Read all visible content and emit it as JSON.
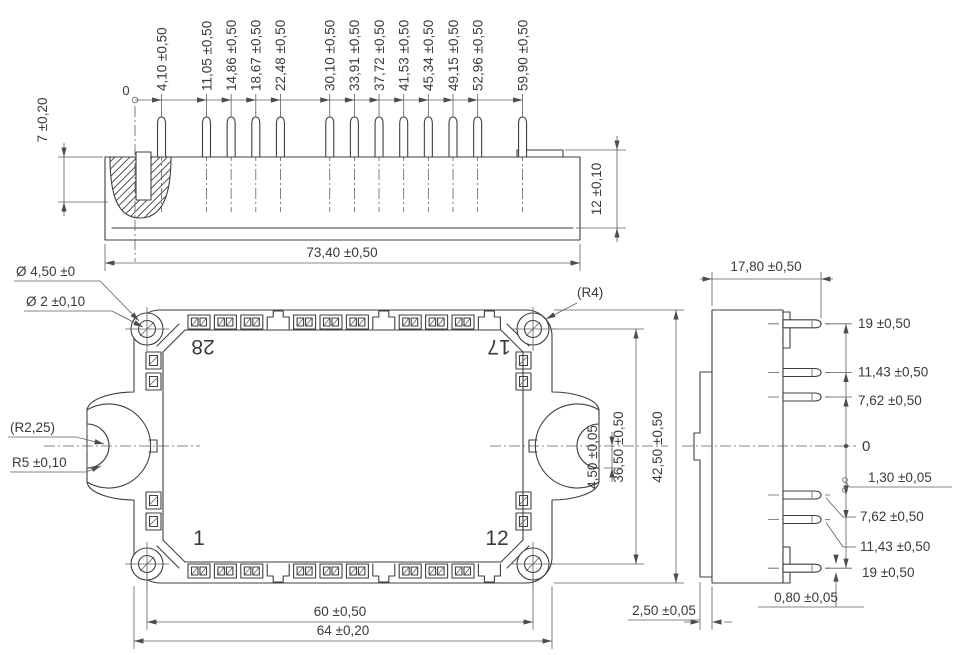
{
  "drawing_title": "power-module-outline-drawing",
  "front_view": {
    "origin_label": "0",
    "pins": [
      {
        "mm": 4.1,
        "label": "4,10 ±0,50"
      },
      {
        "mm": 11.05,
        "label": "11,05 ±0,50"
      },
      {
        "mm": 14.86,
        "label": "14,86 ±0,50"
      },
      {
        "mm": 18.67,
        "label": "18,67 ±0,50"
      },
      {
        "mm": 22.48,
        "label": "22,48 ±0,50"
      },
      {
        "mm": 30.1,
        "label": "30,10 ±0,50"
      },
      {
        "mm": 33.91,
        "label": "33,91 ±0,50"
      },
      {
        "mm": 37.72,
        "label": "37,72 ±0,50"
      },
      {
        "mm": 41.53,
        "label": "41,53 ±0,50"
      },
      {
        "mm": 45.34,
        "label": "45,34 ±0,50"
      },
      {
        "mm": 49.15,
        "label": "49,15 ±0,50"
      },
      {
        "mm": 52.96,
        "label": "52,96 ±0,50"
      },
      {
        "mm": 59.9,
        "label": "59,90 ±0,50"
      }
    ],
    "pin_height": "7 ±0,20",
    "body_height": "12 ±0,10",
    "overall_width": "73,40 ±0,50"
  },
  "top_view": {
    "mount_hole_outer_dia": "Ø 4,50 ±0",
    "mount_hole_inner_dia": "Ø 2 ±0,10",
    "notch_radius_small": "(R2,25)",
    "notch_radius": "R5 ±0,10",
    "corner_radius": "(R4)",
    "terminal_numbers": {
      "top_left": "28",
      "top_right": "17",
      "bottom_left": "1",
      "bottom_right": "12"
    },
    "notch_offset": "4,50 ±0,05",
    "hole_pitch_vertical": "36,50 ±0,50",
    "body_height": "42,50 ±0,50",
    "hole_pitch_horizontal": "60 ±0,50",
    "body_width": "64 ±0,20"
  },
  "side_view": {
    "depth": "17,80 ±0,50",
    "pin_levels": [
      {
        "mm": 19,
        "label": "19 ±0,50"
      },
      {
        "mm": 11.43,
        "label": "11,43 ±0,50"
      },
      {
        "mm": 7.62,
        "label": "7,62 ±0,50"
      },
      {
        "mm": 0,
        "label": "0"
      },
      {
        "mm": -7.62,
        "label": "7,62 ±0,50"
      },
      {
        "mm": -11.43,
        "label": "11,43 ±0,50"
      },
      {
        "mm": -19,
        "label": "19 ±0,50"
      }
    ],
    "pin_width": "1,30 ±0,05",
    "pin_thickness": "0,80 ±0,05",
    "flange_thickness": "2,50 ±0,05"
  }
}
